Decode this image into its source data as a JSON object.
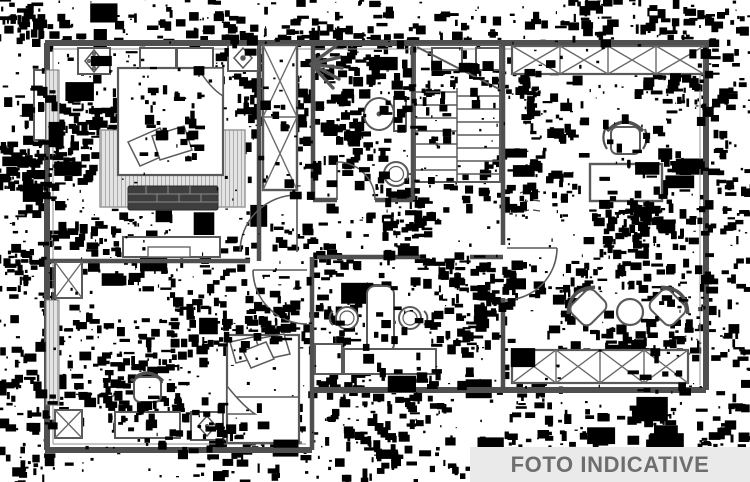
{
  "banner": {
    "label": "FOTO INDICATIVE",
    "background_color": "#eaeaea",
    "text_color": "#6e6e6e"
  },
  "drawing": {
    "kind": "black-and-white apartment floor plan with heavy scan noise",
    "background_color": "#ffffff",
    "wall_color": "#4f4f4f",
    "noise_color": "#000000",
    "rug_fill": "#e3e3e3",
    "bench_fill": "#3e3e3e",
    "icons": [
      "double-bed-icon",
      "pillow-icon",
      "rug-icon",
      "bench-icon",
      "sideboard-icon",
      "wardrobe-cross-icon",
      "door-swing-icon",
      "shower-spray-icon",
      "toilet-icon",
      "washbasin-icon",
      "staircase-icon",
      "window-cross-band-icon",
      "rosette-ornament-icon",
      "desk-icon",
      "desk-chair-icon",
      "armchair-icon",
      "round-table-icon",
      "single-bed-icon",
      "chair-icon",
      "double-washbasin-icon",
      "vanity-cabinet-icon"
    ]
  }
}
